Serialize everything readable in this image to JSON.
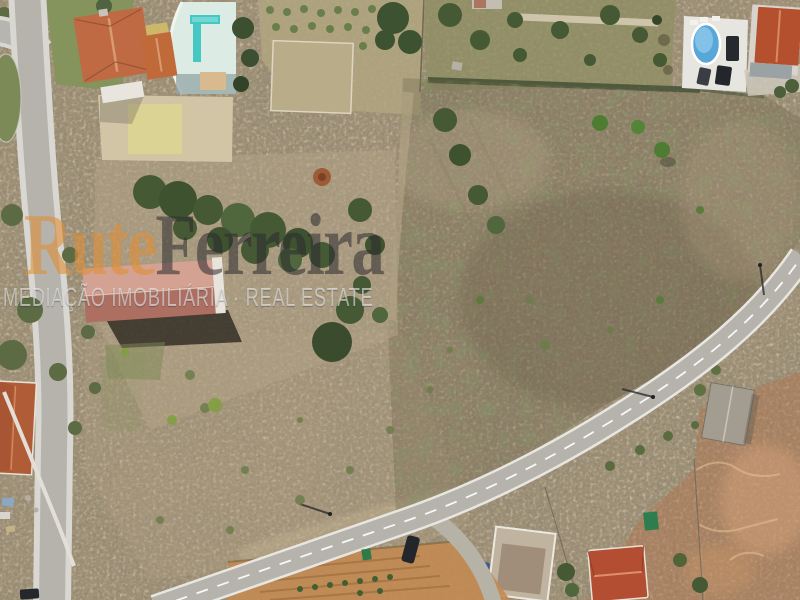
{
  "watermark": {
    "brand_first": "Rute",
    "brand_second": "Ferreira",
    "tagline": "MEDIAÇÃO IMOBILIÁRIA · REAL ESTATE"
  },
  "colors": {
    "scrub_base": "#a3947a",
    "parcel_tint": "#6d5f4a",
    "asphalt": "#b5b3ac",
    "lawn_green": "#85945c",
    "tree_green": "#455935",
    "terracotta_roof": "#bf6a42",
    "warehouse_roof": "#ad6f62",
    "pool_deck": "#dcebe3",
    "pool_water": "#45c7c3",
    "oval_pool_water": "#58a7d8",
    "red_roof_house": "#b44e33",
    "orange_field": "#c28a52",
    "red_soil": "#b4744e",
    "watermark_orange": "#e08e36",
    "watermark_dark": "#2a292e",
    "watermark_light": "#f0f0f0"
  }
}
